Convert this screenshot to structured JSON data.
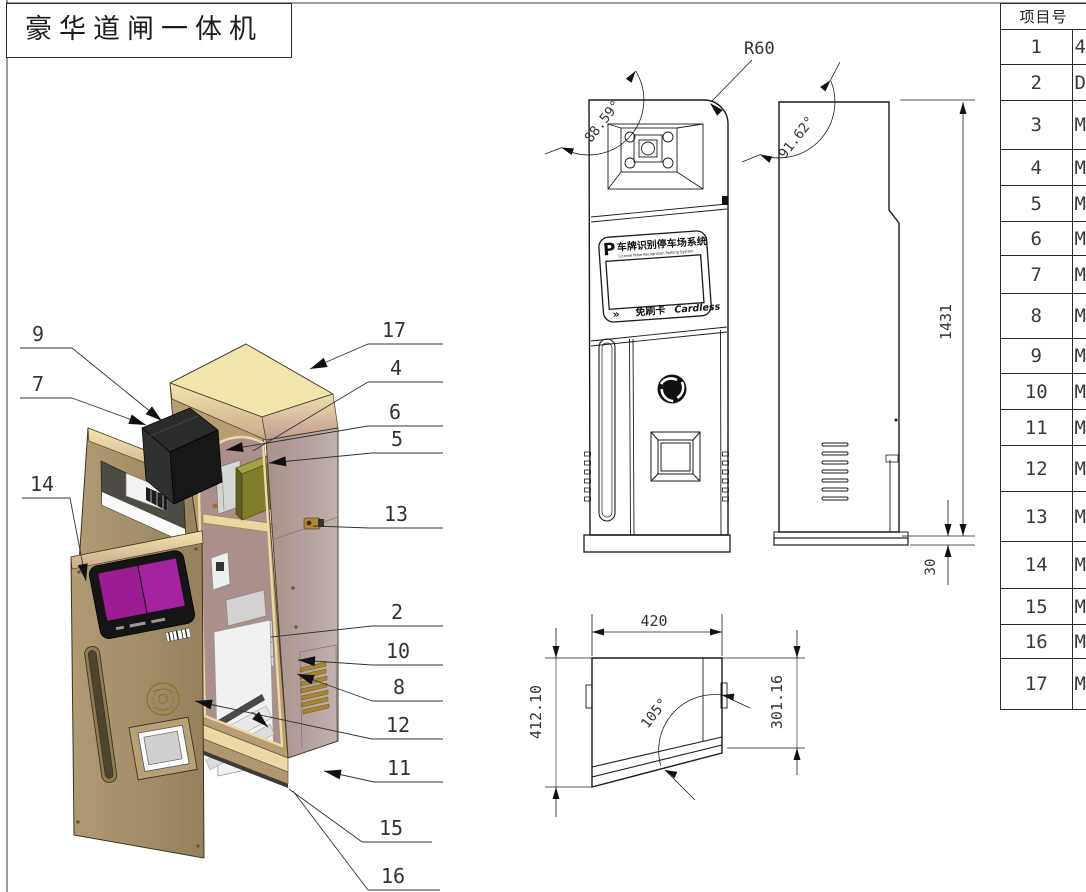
{
  "title": "豪华道闸一体机",
  "parts_table": {
    "header_col1": "项目号",
    "rows": [
      {
        "no": "1",
        "desc_partial": "4"
      },
      {
        "no": "2",
        "desc_partial": "D"
      },
      {
        "no": "3",
        "desc_partial": "M"
      },
      {
        "no": "4",
        "desc_partial": "M"
      },
      {
        "no": "5",
        "desc_partial": "M"
      },
      {
        "no": "6",
        "desc_partial": "M"
      },
      {
        "no": "7",
        "desc_partial": "M"
      },
      {
        "no": "8",
        "desc_partial": "M"
      },
      {
        "no": "9",
        "desc_partial": "M"
      },
      {
        "no": "10",
        "desc_partial": "M"
      },
      {
        "no": "11",
        "desc_partial": "M"
      },
      {
        "no": "12",
        "desc_partial": "M"
      },
      {
        "no": "13",
        "desc_partial": "M"
      },
      {
        "no": "14",
        "desc_partial": "M"
      },
      {
        "no": "15",
        "desc_partial": "M"
      },
      {
        "no": "16",
        "desc_partial": "M"
      },
      {
        "no": "17",
        "desc_partial": "M"
      }
    ]
  },
  "callouts": {
    "left": [
      "9",
      "7",
      "14"
    ],
    "right": [
      "17",
      "4",
      "6",
      "5",
      "13",
      "2",
      "10",
      "8",
      "12",
      "11",
      "15",
      "16"
    ]
  },
  "dims": {
    "corner_radius": "R60",
    "front_top_angle": "88.59°",
    "side_top_angle": "91.62°",
    "height": "1431",
    "base_height": "30",
    "width": "420",
    "left_depth": "412.10",
    "right_depth": "301.16",
    "bottom_angle": "105°"
  },
  "front_view": {
    "sign": {
      "p_logo": "P",
      "title_cn": "车牌识别停车场系统",
      "subtitle_en": "License Plate Recognition Parking System",
      "chevrons": "»",
      "cardless_cn": "免刷卡",
      "cardless_en": "Cardless"
    }
  },
  "colors": {
    "cabinet_tan": "#a8946c",
    "top_cream": "#f1e5ab",
    "side_mauve": "#a48b86",
    "interior_rose": "#ab8f8a",
    "screen_purple": "#9c1d93",
    "camera_black": "#1e1e1e",
    "component_olive": "#8e8c35",
    "accent_gold": "#a8862e",
    "line_black": "#1b1b1b"
  }
}
